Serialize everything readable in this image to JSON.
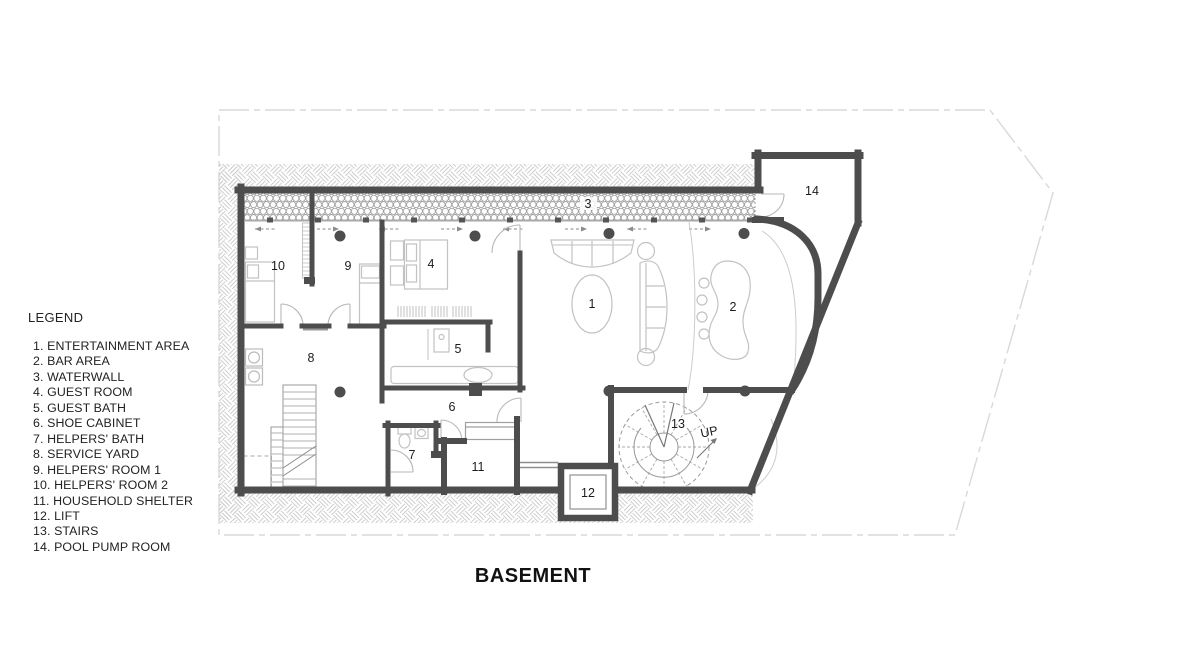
{
  "title": "BASEMENT",
  "legend": {
    "heading": "LEGEND",
    "items": [
      "1. ENTERTAINMENT AREA",
      "2. BAR AREA",
      "3. WATERWALL",
      "4. GUEST ROOM",
      "5. GUEST BATH",
      "6. SHOE CABINET",
      "7. HELPERS' BATH",
      "8. SERVICE YARD",
      "9. HELPERS' ROOM 1",
      "10. HELPERS' ROOM 2",
      "11. HOUSEHOLD SHELTER",
      "12. LIFT",
      "13. STAIRS",
      "14. POOL PUMP ROOM"
    ]
  },
  "plan": {
    "stairs_direction_label": "UP",
    "rooms": [
      {
        "number": "1",
        "name": "ENTERTAINMENT AREA"
      },
      {
        "number": "2",
        "name": "BAR AREA"
      },
      {
        "number": "3",
        "name": "WATERWALL"
      },
      {
        "number": "4",
        "name": "GUEST ROOM"
      },
      {
        "number": "5",
        "name": "GUEST BATH"
      },
      {
        "number": "6",
        "name": "SHOE CABINET"
      },
      {
        "number": "7",
        "name": "HELPERS' BATH"
      },
      {
        "number": "8",
        "name": "SERVICE YARD"
      },
      {
        "number": "9",
        "name": "HELPERS' ROOM 1"
      },
      {
        "number": "10",
        "name": "HELPERS' ROOM 2"
      },
      {
        "number": "11",
        "name": "HOUSEHOLD SHELTER"
      },
      {
        "number": "12",
        "name": "LIFT"
      },
      {
        "number": "13",
        "name": "STAIRS"
      },
      {
        "number": "14",
        "name": "POOL PUMP ROOM"
      }
    ],
    "colors": {
      "wall": "#4d4d4d",
      "furniture": "#c2c2c2",
      "hatch": "#cdcdcd",
      "boundary": "#d9d9d9",
      "text": "#1c1c1c"
    }
  }
}
